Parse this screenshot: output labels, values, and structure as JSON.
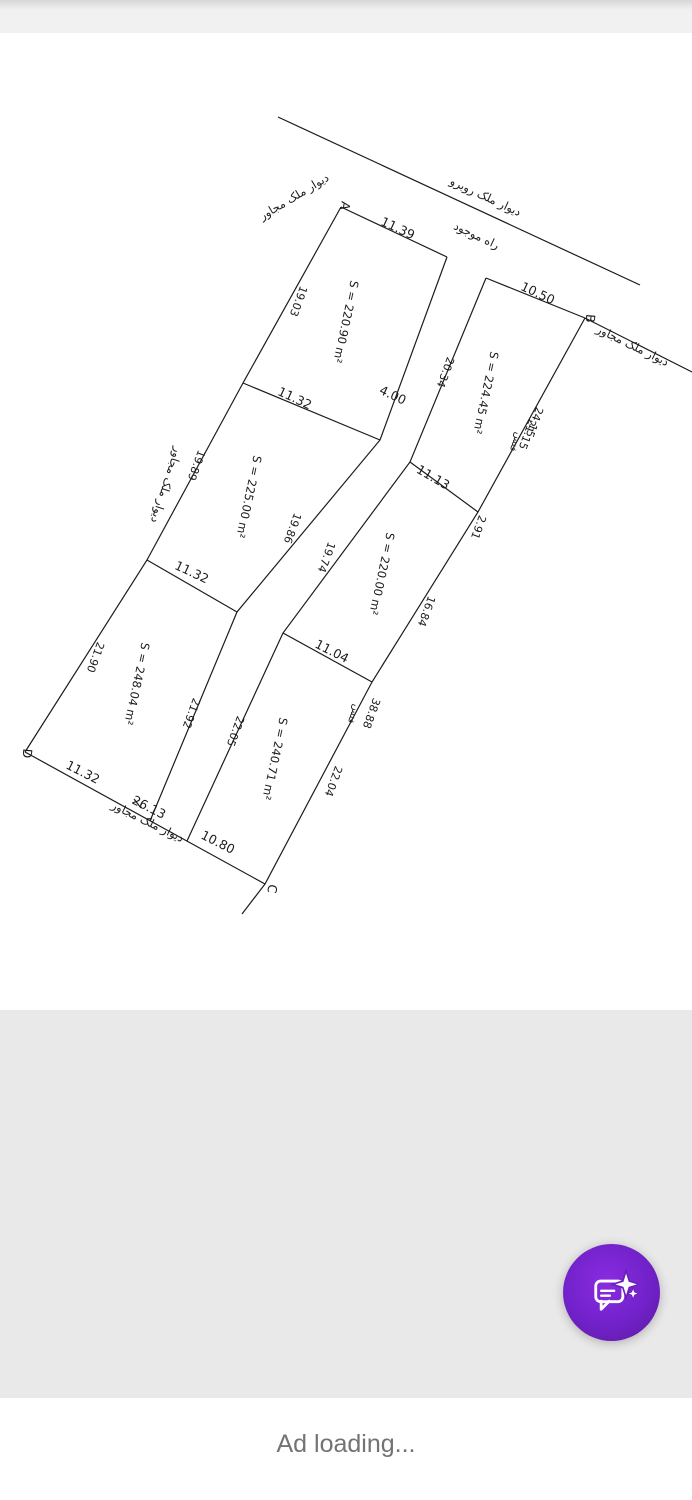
{
  "app": {
    "ad_status": "Ad loading..."
  },
  "colors": {
    "fab_purple_light": "#8a2be2",
    "fab_purple_dark": "#5a189a",
    "ad_text_gray": "#737373",
    "drawing_ink": "#1c1c1c"
  },
  "drawing": {
    "corner_labels": {
      "a": "A",
      "b": "B",
      "c": "C",
      "d": "D"
    },
    "texts": {
      "opposite_wall": "دیوار ملک روبرو",
      "existing_road": "راه موجود",
      "adjacent_wall_top": "دیوار ملک مجاور",
      "adjacent_wall_right": "دیوار ملک مجاور",
      "adjacent_wall_left": "دیوار ملک مجاور",
      "adjacent_wall_bottom": "دیوار ملک مجاور",
      "fence_upper": "فنس",
      "fence_lower": "فنس"
    },
    "areas": {
      "p1": "S = 220.90 m²",
      "p2": "S = 224.45 m²",
      "p3": "S = 225.00 m²",
      "p4": "S = 220.00 m²",
      "p5": "S = 248.04 m²",
      "p6": "S = 240.71 m²"
    },
    "dims": {
      "top_a": "11.39",
      "top_b": "10.50",
      "left_1": "19.03",
      "left_2": "19.89",
      "left_3": "21.90",
      "road_width": "4.00",
      "road_left_1": "19.86",
      "road_left_2": "21.92",
      "road_right_0": "20.34",
      "road_right_1": "19.74",
      "road_right_2": "22.05",
      "right_1a": "24.15",
      "right_1b": "21.15",
      "right_2": "2.91",
      "right_3": "16.84",
      "right_4": "38.88",
      "right_5": "22.04",
      "mid_left_1": "11.32",
      "mid_left_2": "11.32",
      "mid_right_1": "11.13",
      "mid_right_2": "11.04",
      "bottom_1": "11.32",
      "bottom_total": "26.13",
      "bottom_2": "10.80"
    }
  }
}
